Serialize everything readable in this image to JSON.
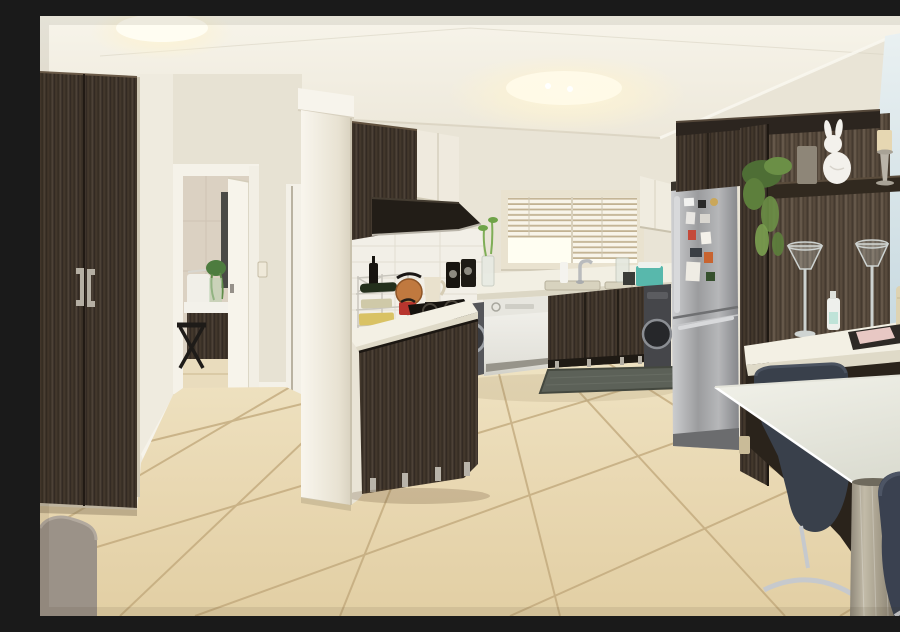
{
  "scene": {
    "title": "Open-plan kitchen interior with dark wood cabinetry, stainless fridge, white appliances, breakfast bar and beige tiled floor",
    "type": "real-estate interior photograph"
  },
  "palette": {
    "wall": "#e9e4d6",
    "ceiling": "#f4f1e7",
    "wall-blue": "#cfdfe6",
    "wood-dark": "#3e342a",
    "wood-light-streak": "#5b4d3f",
    "floor": "#e8d7b0",
    "floor-hall": "#eee0bf",
    "grout": "#bfa679",
    "counter": "#f2efe3",
    "steel": "#a7a8aa",
    "appliance-white": "#eeede7",
    "rug": "#5c6158",
    "table": "#ececе4",
    "chair": "#3a4150",
    "sofa": "#9b9288",
    "metal-leg": "#a79f8d",
    "candle": "#e6d7b2",
    "plant": "#6b8f46"
  },
  "objects": {
    "ceiling": "White ceiling with two warm ceiling lights",
    "wardrobe": "Dark wood double-door wardrobe with vertical metal handles",
    "sofa": "Taupe fabric sofa armrest in lower-left corner",
    "hallway": "Hallway with open white door to bathroom and second doorway",
    "bathroom": "Bathroom with dark vanity, white basin, towel, plant and black folding stool",
    "pillar": "White square structural column",
    "upper-cabinets": "Dark wood end panel with cream upper cabinet doors and dark extractor hood",
    "backsplash": "White tiled splashback with power outlet",
    "window": "Kitchen window with white venetian blinds, half raised",
    "peninsula": "Peninsula counter with chrome wine rack, copper kettle, red pot, coffee bags, bamboo vase and black gas hob",
    "dishwasher": "White freestanding dishwasher",
    "washer-left": "Front-loading machine beside dishwasher",
    "washer-right": "Graphite front-loading washing machine beside fridge",
    "sink": "Stainless inset sink with chrome mixer tap",
    "fridge": "Stainless steel fridge-freezer covered with photo magnets",
    "tall-cabinetry": "Floor-to-ceiling dark wood cabinetry with display shelf",
    "shelf-decor": "White ceramic rabbit, silver candlesticks with cream candles, trailing plant",
    "glass-goblets": "Two tall glass goblet candle holders",
    "bar-counter": "White return counter with soap bottle, flask and tray with pink notepad",
    "table": "White breakfast table on brushed metal leg",
    "chairs": "Dark upholstered bar chairs with chrome bases",
    "rug": "Dark grey kitchen floor mat",
    "floor": "Large beige ceramic floor tiles laid diagonally"
  }
}
